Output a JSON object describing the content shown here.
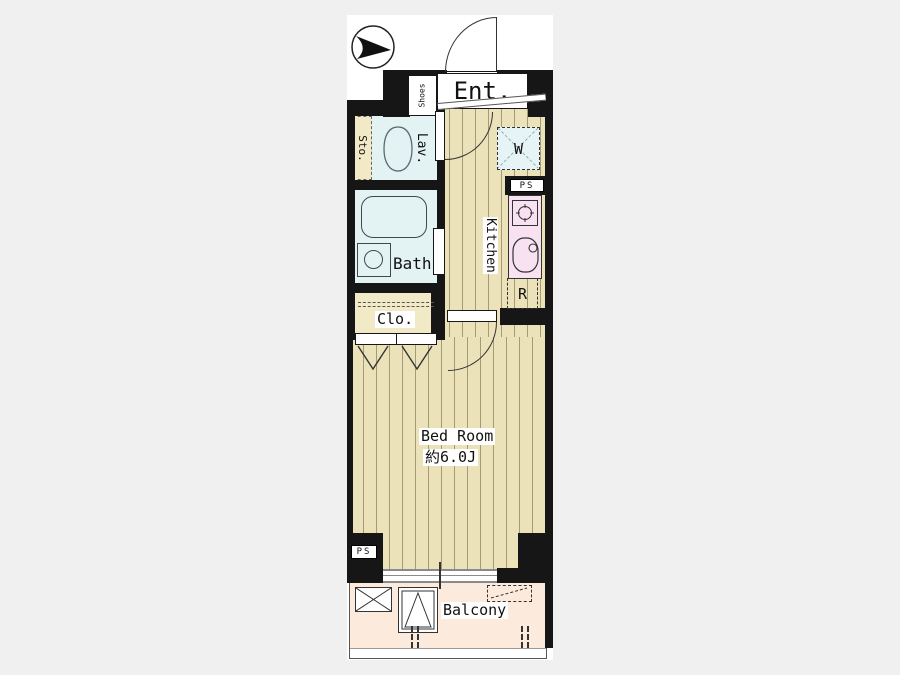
{
  "page": {
    "background_color": "#f0f0f0"
  },
  "plan": {
    "type": "apartment-floor-plan",
    "colors": {
      "wall": "#161616",
      "wood_floor": "#ebe2ba",
      "wet_room": "#e3f3f4",
      "kitchen_counter": "#f8e2f2",
      "balcony_floor": "#fcebdc",
      "closet_storage": "#f2e9c6"
    },
    "labels": {
      "entrance": "Ent.",
      "shoes": "Shoes",
      "storage": "Sto.",
      "lavatory": "Lav.",
      "bath": "Bath",
      "closet": "Clo.",
      "washer_space": "W",
      "pipe_space_kitchen": "PS",
      "pipe_space_balcony": "PS",
      "kitchen": "Kitchen",
      "refrigerator_space": "R",
      "bedroom_name": "Bed Room",
      "bedroom_size": "約6.0J",
      "balcony": "Balcony"
    }
  }
}
